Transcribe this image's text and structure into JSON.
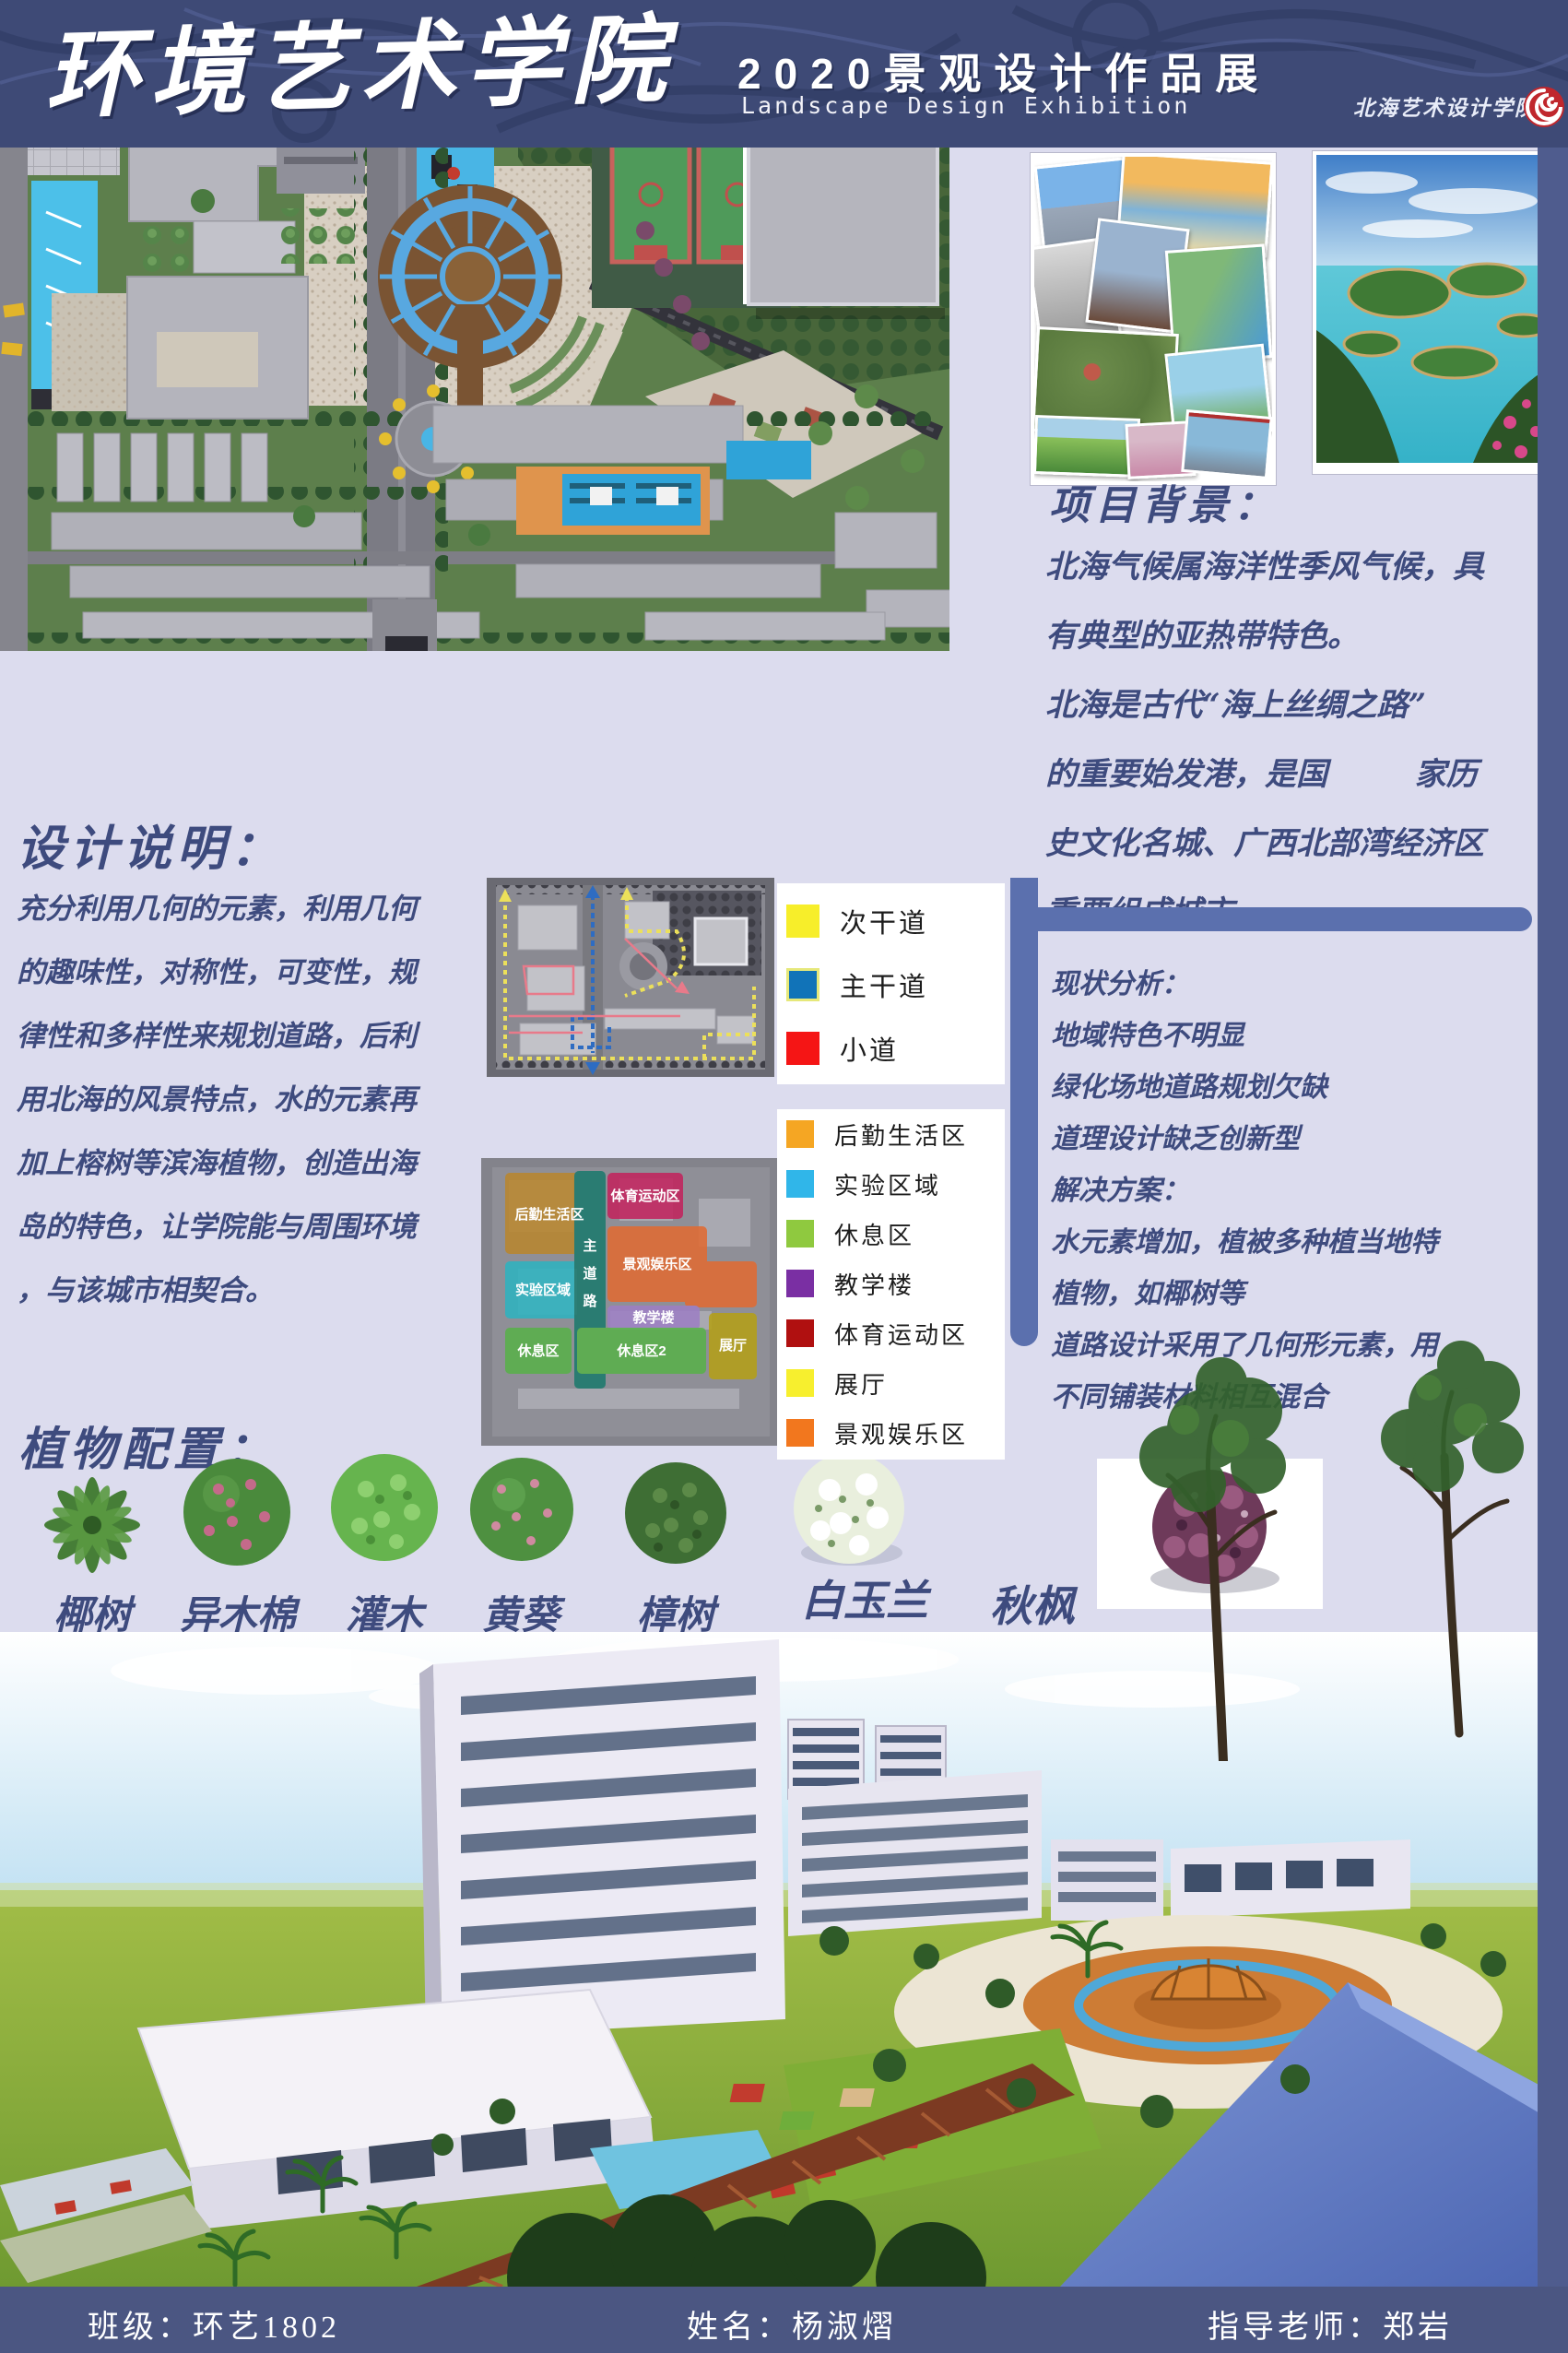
{
  "header": {
    "title": "环境艺术学院",
    "subtitle_cn": "2020景观设计作品展",
    "subtitle_en": "Landscape Design Exhibition",
    "logo_text": "北海艺术设计学院"
  },
  "sections": {
    "project_bg": {
      "title": "项目背景：",
      "body": "北海气候属海洋性季风气候，具\n有典型的亚热带特色。\n北海是古代“海上丝绸之路”\n的重要始发港，是国        家历\n史文化名城、广西北部湾经济区\n重要组成城市。"
    },
    "design_desc": {
      "title": "设计说明：",
      "body": "充分利用几何的元素，利用几何\n的趣味性，对称性，可变性，规\n律性和多样性来规划道路，后利\n用北海的风景特点，水的元素再\n加上榕树等滨海植物，创造出海\n岛的特色，让学院能与周围环境\n，与该城市相契合。"
    },
    "status": {
      "body": "现状分析：\n地域特色不明显\n绿化场地道路规划欠缺\n道理设计缺乏创新型\n解决方案：\n水元素增加，植被多种植当地特\n植物，如椰树等\n道路设计采用了几何形元素，用\n不同铺装材料相互混合"
    },
    "plants_title": "植物配置："
  },
  "legend": {
    "roads": [
      {
        "label": "次干道",
        "color": "#f7ee2a"
      },
      {
        "label": "主干道",
        "color": "#1173b8"
      },
      {
        "label": "小道",
        "color": "#f51515"
      }
    ],
    "zones": [
      {
        "label": "后勤生活区",
        "color": "#f5a623"
      },
      {
        "label": "实验区域",
        "color": "#30b6e9"
      },
      {
        "label": "休息区",
        "color": "#8fc93f"
      },
      {
        "label": "教学楼",
        "color": "#7a2fa3"
      },
      {
        "label": "体育运动区",
        "color": "#b01010"
      },
      {
        "label": "展厅",
        "color": "#f7ef2e"
      },
      {
        "label": "景观娱乐区",
        "color": "#f2771e"
      }
    ]
  },
  "zoning": {
    "areas": {
      "logistics": "后勤生活区",
      "lab": "实验区域",
      "rest1": "休息区",
      "rest2": "休息区2",
      "sports": "体育运动区",
      "entertain": "景观娱乐区",
      "teaching": "教学楼",
      "hall": "展厅"
    },
    "main_road": [
      "主",
      "道",
      "路"
    ]
  },
  "plants": [
    {
      "name": "椰树"
    },
    {
      "name": "异木棉"
    },
    {
      "name": "灌木"
    },
    {
      "name": "黄葵"
    },
    {
      "name": "樟树"
    },
    {
      "name": "白玉兰"
    },
    {
      "name": "秋枫"
    }
  ],
  "footer": {
    "class_label": "班级：环艺1802",
    "name_label": "姓名：杨淑熠",
    "advisor_label": "指导老师：郑岩"
  },
  "colors": {
    "background": "#dcdcee",
    "header": "#3e4a76",
    "footer": "#4b5682",
    "side_strip": "#4f5c8e",
    "divider": "#5b70ae",
    "text": "#3e4b7e",
    "logo_red": "#c0272d"
  }
}
